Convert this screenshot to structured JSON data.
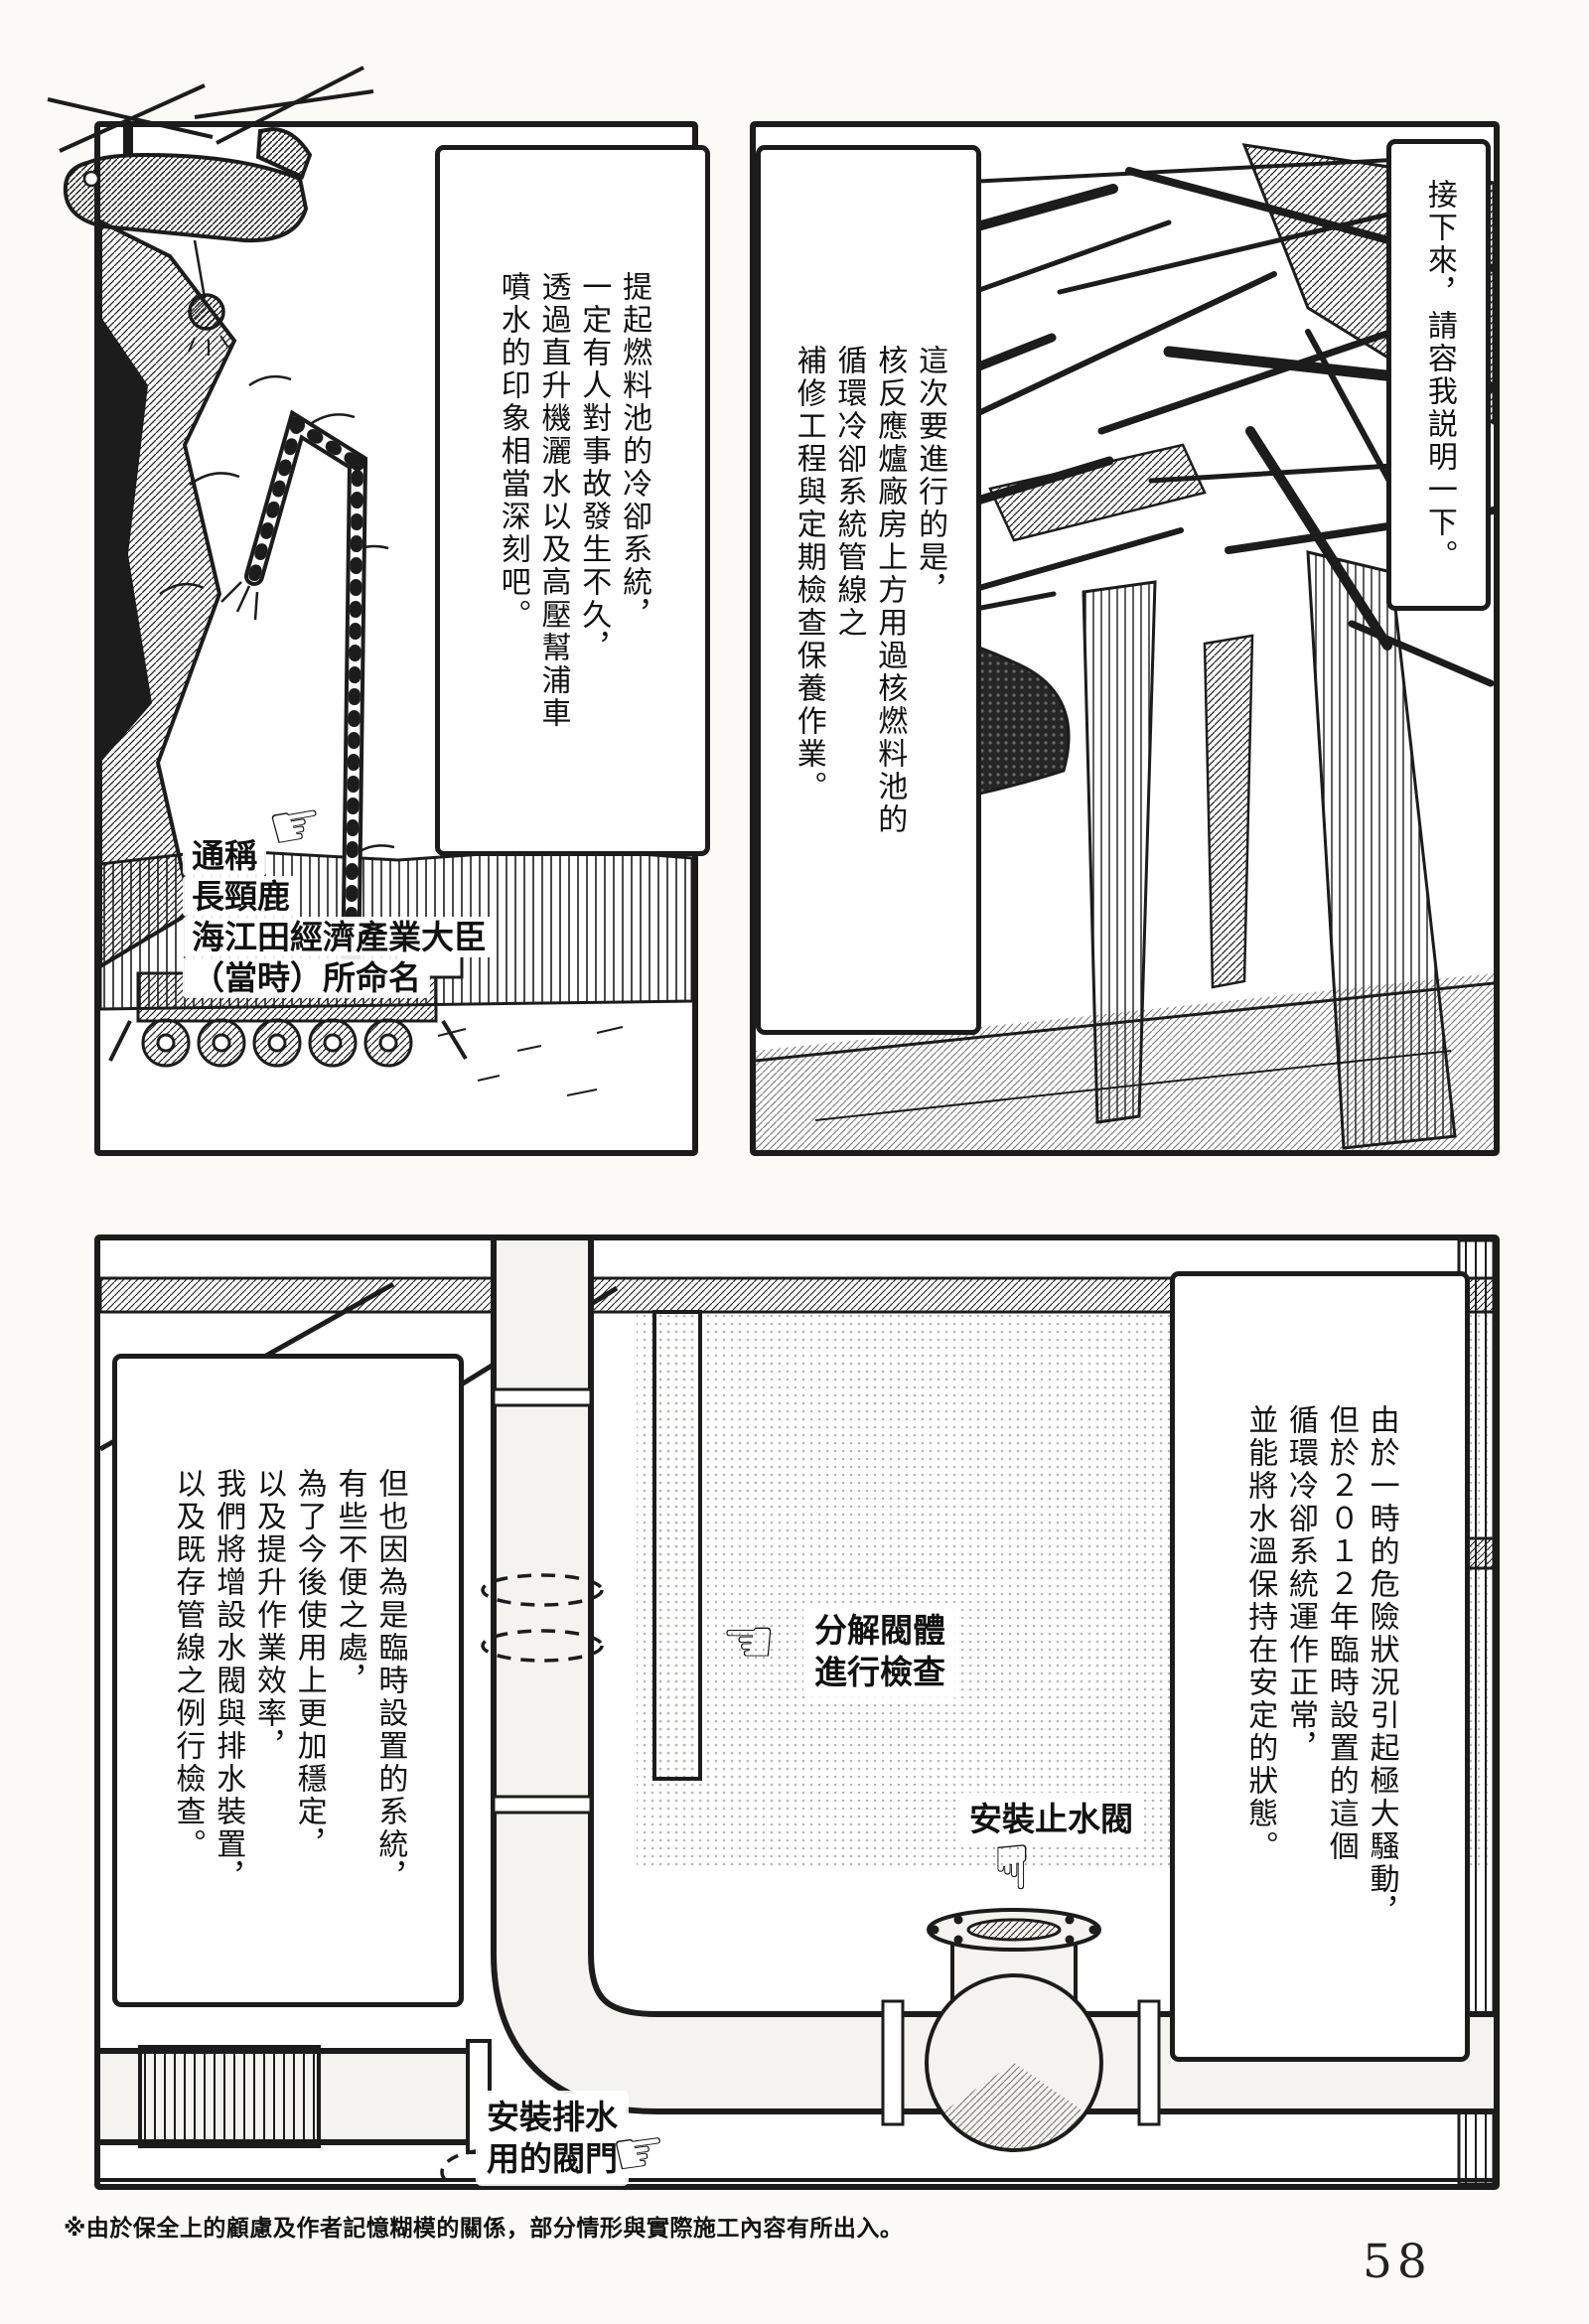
{
  "colors": {
    "ink": "#1c1c1c",
    "paper": "#fbfaf7",
    "pipe_fill": "#f4f3ef",
    "tone": "#b9b6af"
  },
  "icons": {
    "hand_right": "☞",
    "hand_left": "☜",
    "hand_down": "☟"
  },
  "page": {
    "footnote": "※由於保全上的顧慮及作者記憶糊模的關係，部分情形與實際施工內容有所出入。",
    "number": "58"
  },
  "top_left_panel": {
    "caption": "提起燃料池的冷卻系統，\n一定有人對事故發生不久，\n透過直升機灑水以及高壓幫浦車\n噴水的印象相當深刻吧。",
    "machine_label": {
      "line1": "通稱",
      "line2": "長頸鹿",
      "line3": "海江田經濟產業大臣",
      "line4": "（當時）所命名"
    }
  },
  "top_right_panel": {
    "caption": "這次要進行的是，\n核反應爐廠房上方用過核燃料池的\n循環冷卻系統管線之\n補修工程與定期檢查保養作業。"
  },
  "narrator_box": {
    "caption": "接下來，請容我説明一下。"
  },
  "bottom_panel": {
    "caption_left": "但也因為是臨時設置的系統，\n有些不便之處，\n為了今後使用上更加穩定，\n以及提升作業效率，\n我們將增設水閥與排水裝置，\n以及既存管線之例行檢查。",
    "caption_right": "由於一時的危險狀況引起極大騷動，\n但於２０１２年臨時設置的這個\n循環冷卻系統運作正常，\n並能將水溫保持在安定的狀態。",
    "label_disassemble": "分解閥體\n進行檢查",
    "label_stop_valve": "安裝止水閥",
    "label_drain": "安裝排水\n用的閥門"
  }
}
